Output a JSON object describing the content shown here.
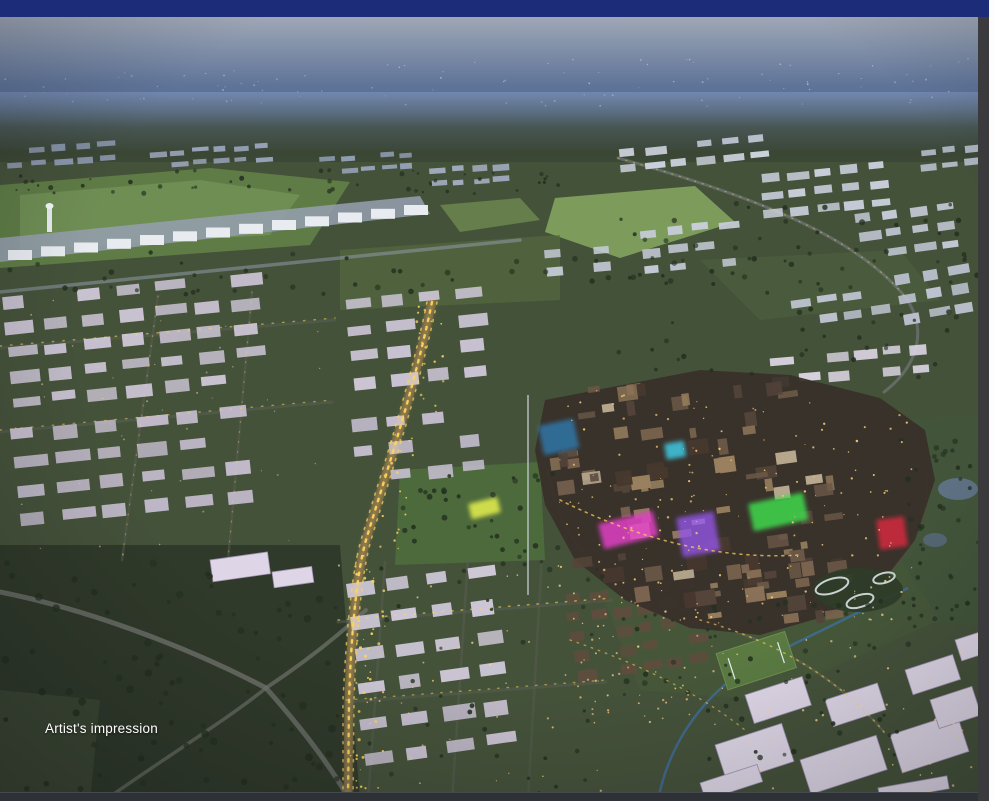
{
  "chrome": {
    "top_bar_color": "#1d2c78",
    "bottom_bar_color": "#2e3136",
    "right_strip_color": "#3b3b3d",
    "page_edge_color": "#fdfdfd"
  },
  "photo": {
    "caption": "Artist's impression",
    "palette": {
      "sky_top": "#b0b4bd",
      "sky_mid": "#7486a3",
      "sky_deep": "#49628f",
      "ground": "#45523a",
      "rural": "#303a2a",
      "field_light": "#7d9c5c",
      "field_mid": "#5f7c46",
      "estate": "#ccc5d6",
      "estate_far": "#9aa4ba",
      "white_big": "#ded6e6",
      "road_gray": "#6d716a",
      "gold": "#ffd35e",
      "city_base": "#39302a",
      "neon_magenta": "#e03fc4",
      "neon_purple": "#9355e6",
      "neon_green": "#3fd94d",
      "neon_red": "#cb2a3c",
      "neon_cyan": "#3fd2ee",
      "water": "#5d7183"
    },
    "scene": {
      "terminal": {
        "x1": 8,
        "y1": 250,
        "x2": 404,
        "y2": 205,
        "count": 13,
        "w": 24,
        "h": 10
      },
      "estates": [
        {
          "x": 6,
          "y": 148,
          "rot": -4,
          "cols": 5,
          "rows": 2,
          "cw": 16,
          "ch": 6,
          "gx": 7,
          "gy": 8,
          "fill": "#8f9ab2"
        },
        {
          "x": 150,
          "y": 152,
          "rot": -4,
          "cols": 6,
          "rows": 2,
          "cw": 14,
          "ch": 5,
          "gx": 7,
          "gy": 7,
          "fill": "#9aa4ba"
        },
        {
          "x": 320,
          "y": 158,
          "rot": -4,
          "cols": 5,
          "rows": 2,
          "cw": 13,
          "ch": 5,
          "gx": 7,
          "gy": 7,
          "fill": "#93a0b6"
        },
        {
          "x": 430,
          "y": 168,
          "rot": -4,
          "cols": 4,
          "rows": 2,
          "cw": 14,
          "ch": 6,
          "gx": 7,
          "gy": 8,
          "fill": "#a3adc0"
        },
        {
          "x": 920,
          "y": 150,
          "rot": -6,
          "cols": 3,
          "rows": 2,
          "cw": 15,
          "ch": 6,
          "gx": 7,
          "gy": 8,
          "fill": "#b8bfce"
        },
        {
          "x": 618,
          "y": 150,
          "rot": -6,
          "cols": 6,
          "rows": 2,
          "cw": 18,
          "ch": 7,
          "gx": 8,
          "gy": 9,
          "fill": "#cdd2de"
        },
        {
          "x": 760,
          "y": 175,
          "rot": -6,
          "cols": 5,
          "rows": 3,
          "cw": 18,
          "ch": 8,
          "gx": 9,
          "gy": 10,
          "fill": "#c8cdda"
        },
        {
          "x": 855,
          "y": 215,
          "rot": -8,
          "cols": 4,
          "rows": 3,
          "cw": 18,
          "ch": 8,
          "gx": 9,
          "gy": 11,
          "fill": "#c4c9d6"
        },
        {
          "x": 895,
          "y": 275,
          "rot": -10,
          "cols": 3,
          "rows": 3,
          "cw": 18,
          "ch": 9,
          "gx": 9,
          "gy": 11,
          "fill": "#bfc4d2"
        },
        {
          "x": 790,
          "y": 300,
          "rot": -8,
          "cols": 4,
          "rows": 2,
          "cw": 17,
          "ch": 8,
          "gx": 9,
          "gy": 10,
          "fill": "#c2c6d4"
        },
        {
          "x": 640,
          "y": 230,
          "rot": -6,
          "cols": 4,
          "rows": 3,
          "cw": 17,
          "ch": 8,
          "gx": 9,
          "gy": 11,
          "fill": "#c9cedb"
        },
        {
          "x": 545,
          "y": 250,
          "rot": -5,
          "cols": 3,
          "rows": 2,
          "cw": 16,
          "ch": 8,
          "gx": 8,
          "gy": 10,
          "fill": "#c6cbd8"
        },
        {
          "x": 770,
          "y": 358,
          "rot": -5,
          "cols": 6,
          "rows": 2,
          "cw": 20,
          "ch": 9,
          "gx": 8,
          "gy": 10,
          "fill": "#d6d0dd"
        },
        {
          "x": 2,
          "y": 298,
          "rot": -6,
          "cols": 7,
          "rows": 5,
          "cw": 26,
          "ch": 11,
          "gx": 12,
          "gy": 14,
          "fill": "#c9c2d2"
        },
        {
          "x": 10,
          "y": 430,
          "rot": -6,
          "cols": 6,
          "rows": 4,
          "cw": 28,
          "ch": 12,
          "gx": 14,
          "gy": 16,
          "fill": "#c4bccd"
        },
        {
          "x": 345,
          "y": 300,
          "rot": -6,
          "cols": 4,
          "rows": 4,
          "cw": 24,
          "ch": 11,
          "gx": 13,
          "gy": 15,
          "fill": "#ccc5d6"
        },
        {
          "x": 350,
          "y": 420,
          "rot": -6,
          "cols": 4,
          "rows": 3,
          "cw": 22,
          "ch": 11,
          "gx": 14,
          "gy": 16,
          "fill": "#c6bed0"
        },
        {
          "x": 345,
          "y": 585,
          "rot": -8,
          "cols": 4,
          "rows": 4,
          "cw": 26,
          "ch": 13,
          "gx": 15,
          "gy": 20,
          "fill": "#cfc8d8"
        },
        {
          "x": 360,
          "y": 720,
          "rot": -8,
          "cols": 4,
          "rows": 2,
          "cw": 26,
          "ch": 13,
          "gx": 15,
          "gy": 20,
          "fill": "#c8c0d1"
        },
        {
          "x": 565,
          "y": 595,
          "rot": -8,
          "cols": 6,
          "rows": 5,
          "cw": 16,
          "ch": 10,
          "gx": 7,
          "gy": 9,
          "fill": "#5d4d3d"
        }
      ],
      "big_buildings": [
        {
          "x": 210,
          "y": 560,
          "w": 58,
          "h": 22,
          "rot": -8
        },
        {
          "x": 272,
          "y": 572,
          "w": 40,
          "h": 16,
          "rot": -8
        },
        {
          "x": 715,
          "y": 745,
          "w": 70,
          "h": 40,
          "rot": -18
        },
        {
          "x": 800,
          "y": 760,
          "w": 80,
          "h": 36,
          "rot": -18
        },
        {
          "x": 890,
          "y": 735,
          "w": 70,
          "h": 40,
          "rot": -18
        },
        {
          "x": 930,
          "y": 700,
          "w": 44,
          "h": 30,
          "rot": -18
        },
        {
          "x": 745,
          "y": 695,
          "w": 60,
          "h": 30,
          "rot": -18
        },
        {
          "x": 825,
          "y": 700,
          "w": 55,
          "h": 28,
          "rot": -18
        },
        {
          "x": 905,
          "y": 670,
          "w": 50,
          "h": 26,
          "rot": -18
        },
        {
          "x": 955,
          "y": 640,
          "w": 30,
          "h": 22,
          "rot": -18
        },
        {
          "x": 700,
          "y": 783,
          "w": 60,
          "h": 18,
          "rot": -18
        },
        {
          "x": 878,
          "y": 788,
          "w": 70,
          "h": 13,
          "rot": -10
        }
      ],
      "city_zones": [
        {
          "x": 548,
          "y": 380,
          "w": 250,
          "h": 120,
          "count": 38
        },
        {
          "x": 560,
          "y": 470,
          "w": 300,
          "h": 120,
          "count": 38
        },
        {
          "x": 600,
          "y": 560,
          "w": 260,
          "h": 65,
          "count": 24
        }
      ],
      "city_palette": [
        "#6b5847",
        "#7c6550",
        "#54443a",
        "#8d7459",
        "#47382e",
        "#9a815f",
        "#b9aa90"
      ],
      "neon_patches": [
        {
          "x": 598,
          "y": 524,
          "w": 56,
          "h": 26,
          "rot": -14,
          "color": "#e03fc4",
          "op": 0.85
        },
        {
          "x": 676,
          "y": 518,
          "w": 38,
          "h": 40,
          "rot": -10,
          "color": "#9355e6",
          "op": 0.8
        },
        {
          "x": 748,
          "y": 504,
          "w": 56,
          "h": 28,
          "rot": -12,
          "color": "#3fd94d",
          "op": 0.85
        },
        {
          "x": 876,
          "y": 520,
          "w": 28,
          "h": 30,
          "rot": -8,
          "color": "#cb2a3c",
          "op": 0.9
        },
        {
          "x": 664,
          "y": 444,
          "w": 20,
          "h": 16,
          "rot": -10,
          "color": "#3fd2ee",
          "op": 0.8
        },
        {
          "x": 538,
          "y": 426,
          "w": 36,
          "h": 30,
          "rot": -12,
          "color": "#2e7fb8",
          "op": 0.75
        },
        {
          "x": 468,
          "y": 504,
          "w": 30,
          "h": 16,
          "rot": -14,
          "color": "#dde84e",
          "op": 0.9
        }
      ],
      "gray_roads": [
        {
          "d": "M0,292 L520,240",
          "color": "#8e99a9",
          "w": 3.5,
          "op": 0.55
        },
        {
          "d": "M0,592 C90,610 190,648 266,688",
          "color": "#6d716a",
          "w": 5,
          "op": 0.85
        },
        {
          "d": "M266,688 C298,724 330,764 350,801",
          "color": "#6d716a",
          "w": 5,
          "op": 0.8
        },
        {
          "d": "M266,688 C224,722 152,766 104,801",
          "color": "#6d716a",
          "w": 3.5,
          "op": 0.7
        },
        {
          "d": "M266,688 C308,660 338,636 366,610",
          "color": "#6d716a",
          "w": 4,
          "op": 0.75
        },
        {
          "d": "M432,300 C414,390 384,480 366,540 C356,575 351,640 349,700 L348,801",
          "color": "#6b5f45",
          "w": 9,
          "op": 0.9
        },
        {
          "d": "M0,348 L335,320",
          "color": "#5a5f56",
          "w": 3,
          "op": 0.5
        },
        {
          "d": "M0,432 L332,402",
          "color": "#5a5f56",
          "w": 3,
          "op": 0.5
        },
        {
          "d": "M158,296 L122,560",
          "color": "#5a5f56",
          "w": 2.5,
          "op": 0.45
        },
        {
          "d": "M252,292 L228,560",
          "color": "#5a5f56",
          "w": 2.5,
          "op": 0.45
        },
        {
          "d": "M338,622 L612,600",
          "color": "#5a5f56",
          "w": 3,
          "op": 0.5
        },
        {
          "d": "M346,702 L606,682",
          "color": "#5a5f56",
          "w": 3,
          "op": 0.45
        },
        {
          "d": "M385,562 L368,801",
          "color": "#5a5f56",
          "w": 2.5,
          "op": 0.45
        },
        {
          "d": "M468,558 L452,801",
          "color": "#5a5f56",
          "w": 2.5,
          "op": 0.45
        },
        {
          "d": "M542,556 L528,801",
          "color": "#5a5f56",
          "w": 2.5,
          "op": 0.4
        },
        {
          "d": "M618,158 C760,198 858,238 906,298 C928,330 918,366 884,392",
          "color": "#7b8089",
          "w": 3,
          "op": 0.55
        },
        {
          "d": "M548,470 C560,540 600,585 660,612",
          "color": "#564a3c",
          "w": 3,
          "op": 0.5
        },
        {
          "d": "M925,470 C935,520 905,565 860,595",
          "color": "#564a3c",
          "w": 3,
          "op": 0.45
        },
        {
          "d": "M700,620 C780,642 842,682 884,732",
          "color": "#6e6a58",
          "w": 2.5,
          "op": 0.5
        }
      ],
      "glow_roads": [
        {
          "d": "M432,302 C414,390 384,480 366,540 C356,575 351,640 349,700 L348,801",
          "color": "#ffd35e",
          "w": 6,
          "op": 0.3,
          "blur": true
        },
        {
          "d": "M432,302 C414,390 384,480 366,540 C356,575 351,640 349,700 L348,801",
          "color": "#ffd35e",
          "w": 2.4,
          "dash": "2.5 6",
          "op": 0.95
        },
        {
          "d": "M437,302 C419,390 389,480 371,540 C361,575 356,640 354,700 L353,801",
          "color": "#ffd35e",
          "w": 1.6,
          "dash": "2 7",
          "op": 0.7
        },
        {
          "d": "M427,302 C409,390 379,480 361,540 C351,575 346,640 343,700 L343,801",
          "color": "#ffd35e",
          "w": 1.6,
          "dash": "2 7",
          "op": 0.7
        },
        {
          "d": "M0,346 L335,318",
          "color": "#ffd35e",
          "w": 1.4,
          "dash": "1.5 9",
          "op": 0.55
        },
        {
          "d": "M0,430 L332,400",
          "color": "#ffd35e",
          "w": 1.4,
          "dash": "1.5 9",
          "op": 0.5
        },
        {
          "d": "M338,620 L612,598",
          "color": "#ffd35e",
          "w": 1.5,
          "dash": "1.5 8",
          "op": 0.6
        },
        {
          "d": "M346,700 L606,680",
          "color": "#ffd35e",
          "w": 1.4,
          "dash": "1.5 8",
          "op": 0.5
        },
        {
          "d": "M618,158 C760,198 858,238 906,298",
          "color": "#ffd35e",
          "w": 1.2,
          "dash": "1 7",
          "op": 0.45
        },
        {
          "d": "M700,620 C780,642 842,682 884,732",
          "color": "#ffd35e",
          "w": 1.5,
          "dash": "1.5 6",
          "op": 0.6
        },
        {
          "d": "M570,640 C640,664 700,694 745,730",
          "color": "#ffd35e",
          "w": 1.4,
          "dash": "1.5 6",
          "op": 0.55
        },
        {
          "d": "M560,500 C640,540 720,560 800,555",
          "color": "#ffd35e",
          "w": 1.6,
          "dash": "2 5",
          "op": 0.7
        },
        {
          "d": "M158,296 L122,560",
          "color": "#ffd35e",
          "w": 1.1,
          "dash": "1 9",
          "op": 0.4
        },
        {
          "d": "M252,292 L228,560",
          "color": "#ffd35e",
          "w": 1.1,
          "dash": "1 9",
          "op": 0.4
        }
      ],
      "tree_zones": [
        {
          "x": 0,
          "y": 170,
          "w": 560,
          "h": 24,
          "count": 50,
          "rmin": 1,
          "rmax": 2.5
        },
        {
          "x": 0,
          "y": 250,
          "w": 978,
          "h": 45,
          "count": 60,
          "rmin": 1.5,
          "rmax": 3
        },
        {
          "x": 400,
          "y": 470,
          "w": 160,
          "h": 100,
          "count": 35,
          "rmin": 1.5,
          "rmax": 3
        },
        {
          "x": 0,
          "y": 560,
          "w": 340,
          "h": 240,
          "count": 80,
          "rmin": 2,
          "rmax": 4
        },
        {
          "x": 900,
          "y": 430,
          "w": 78,
          "h": 190,
          "count": 40,
          "rmin": 1.5,
          "rmax": 3
        },
        {
          "x": 620,
          "y": 600,
          "w": 300,
          "h": 160,
          "count": 60,
          "rmin": 1.5,
          "rmax": 3
        },
        {
          "x": 330,
          "y": 560,
          "w": 280,
          "h": 240,
          "count": 40,
          "rmin": 1.5,
          "rmax": 2.5
        },
        {
          "x": 600,
          "y": 200,
          "w": 378,
          "h": 180,
          "count": 60,
          "rmin": 1.5,
          "rmax": 3
        }
      ],
      "light_zones": [
        {
          "x": 380,
          "y": 58,
          "w": 590,
          "h": 48,
          "count": 60,
          "color": "#e8edf5",
          "rmin": 0.5,
          "rmax": 1,
          "op": 0.5
        },
        {
          "x": 0,
          "y": 70,
          "w": 380,
          "h": 35,
          "count": 35,
          "color": "#dfe6f0",
          "rmin": 0.5,
          "rmax": 1,
          "op": 0.45
        },
        {
          "x": 555,
          "y": 390,
          "w": 360,
          "h": 230,
          "count": 170,
          "color": "#ffd27a",
          "rmin": 0.5,
          "rmax": 1.3,
          "op": 0.9
        },
        {
          "x": 565,
          "y": 595,
          "w": 160,
          "h": 130,
          "count": 60,
          "color": "#ffce86",
          "rmin": 0.5,
          "rmax": 1.2,
          "op": 0.85
        },
        {
          "x": 335,
          "y": 565,
          "w": 270,
          "h": 230,
          "count": 45,
          "color": "#ffd58a",
          "rmin": 0.6,
          "rmax": 1.2,
          "op": 0.8
        },
        {
          "x": 0,
          "y": 300,
          "w": 330,
          "h": 255,
          "count": 40,
          "color": "#e8d9a8",
          "rmin": 0.5,
          "rmax": 1,
          "op": 0.6
        },
        {
          "x": 700,
          "y": 640,
          "w": 278,
          "h": 160,
          "count": 45,
          "color": "#ffd892",
          "rmin": 0.6,
          "rmax": 1.3,
          "op": 0.85
        },
        {
          "x": 355,
          "y": 540,
          "w": 30,
          "h": 260,
          "count": 40,
          "color": "#ffd35e",
          "rmin": 0.8,
          "rmax": 1.6,
          "op": 0.95
        },
        {
          "x": 380,
          "y": 430,
          "w": 40,
          "h": 120,
          "count": 20,
          "color": "#ffd35e",
          "rmin": 0.8,
          "rmax": 1.4,
          "op": 0.9
        },
        {
          "x": 415,
          "y": 300,
          "w": 30,
          "h": 140,
          "count": 18,
          "color": "#ffd35e",
          "rmin": 0.8,
          "rmax": 1.4,
          "op": 0.9
        }
      ]
    }
  }
}
